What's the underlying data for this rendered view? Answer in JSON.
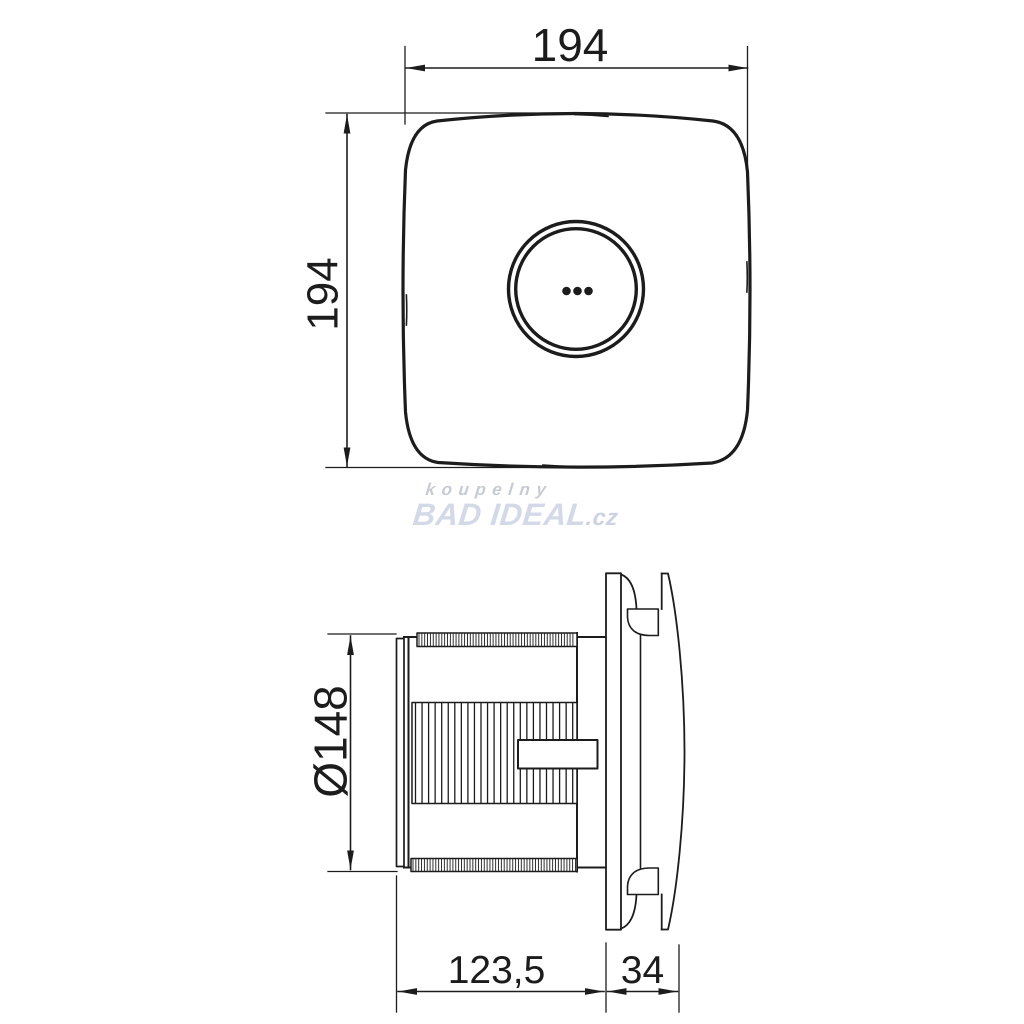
{
  "watermark": {
    "line1": "koupelny",
    "brand": "BAD IDEAL",
    "suffix": ".cz",
    "color_line1": "#c7cbd4",
    "color_brand": "#d4d9e8"
  },
  "dimensions": {
    "front_width": "194",
    "front_height": "194",
    "duct_diameter": "Ø148",
    "body_depth": "123,5",
    "front_depth": "34"
  },
  "drawing": {
    "line_color": "#1c1c1c",
    "background": "#ffffff"
  }
}
